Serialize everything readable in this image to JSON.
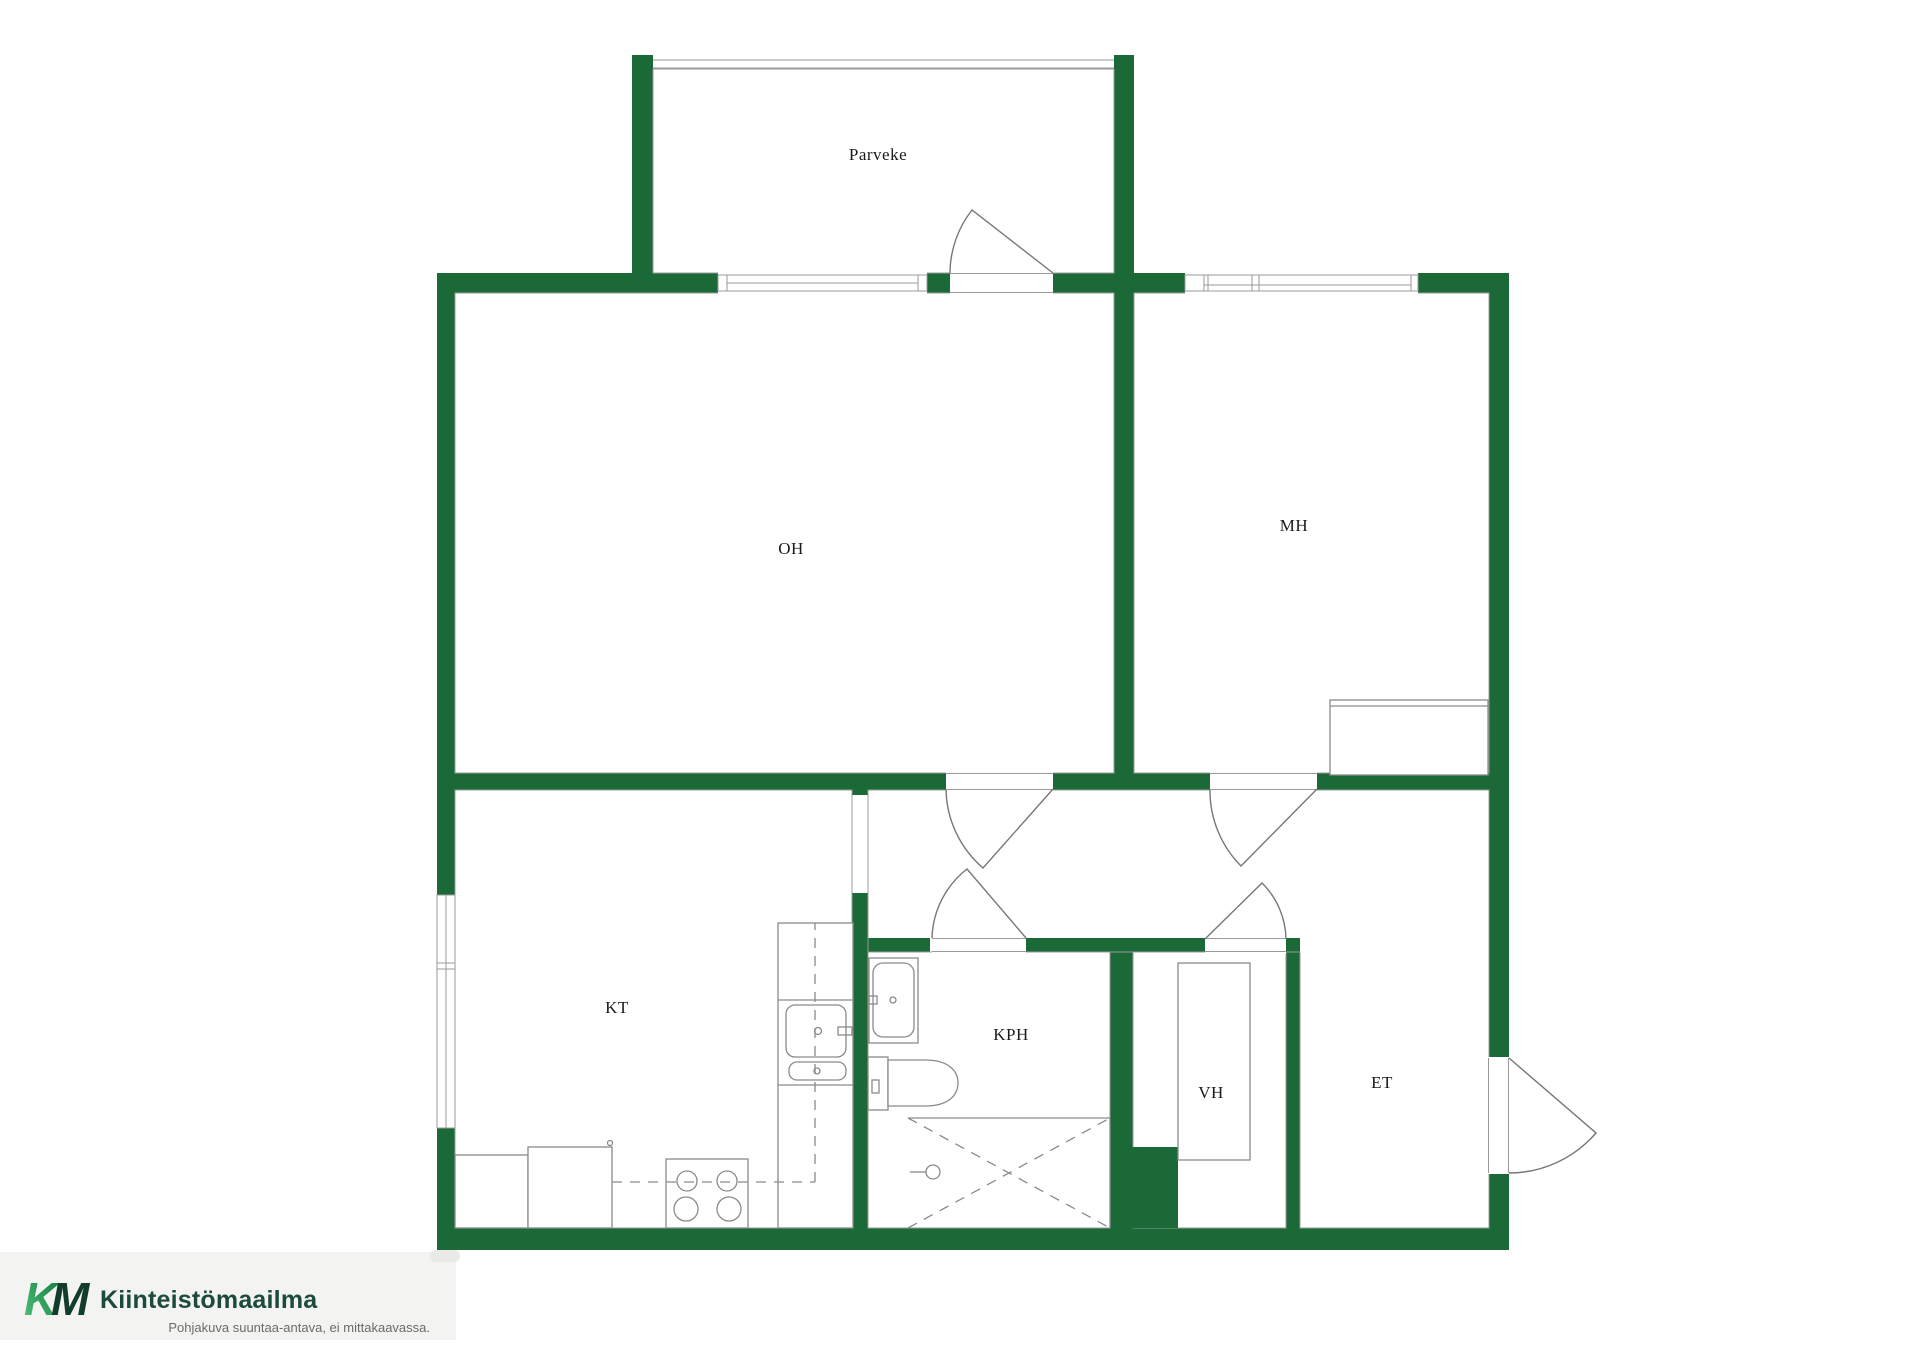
{
  "title": "Apartment floor plan",
  "rooms": [
    {
      "id": "parveke",
      "label": "Parveke"
    },
    {
      "id": "oh",
      "label": "OH"
    },
    {
      "id": "mh",
      "label": "MH"
    },
    {
      "id": "kt",
      "label": "KT"
    },
    {
      "id": "kph",
      "label": "KPH"
    },
    {
      "id": "vh",
      "label": "VH"
    },
    {
      "id": "et",
      "label": "ET"
    }
  ],
  "branding": {
    "logo_k": "K",
    "logo_m": "M",
    "company": "Kiinteistömaailma",
    "disclaimer": "Pohjakuva suuntaa-antava, ei mittakaavassa."
  },
  "fixtures": [
    "balcony-railing-icon",
    "window-icon",
    "swing-door-icon",
    "kitchen-counter-icon",
    "stove-icon",
    "kitchen-sink-icon",
    "upper-cabinet-dashed-icon",
    "washbasin-icon",
    "toilet-icon",
    "shower-icon",
    "floor-drain-icon",
    "wardrobe-icon",
    "bed-icon",
    "entrance-door-icon"
  ],
  "colors": {
    "wall": "#1a6936",
    "line": "#8a8a8a",
    "thin": "#9a9a9a",
    "label": "#1a1a1a",
    "logo_dark": "#1c4a3c",
    "logo_m": "#123d2b",
    "logo_grad_start": "#52c47c",
    "logo_grad_end": "#0f7a3c",
    "tagline": "#6b6b6b",
    "logo_bg": "#f3f3f1"
  }
}
